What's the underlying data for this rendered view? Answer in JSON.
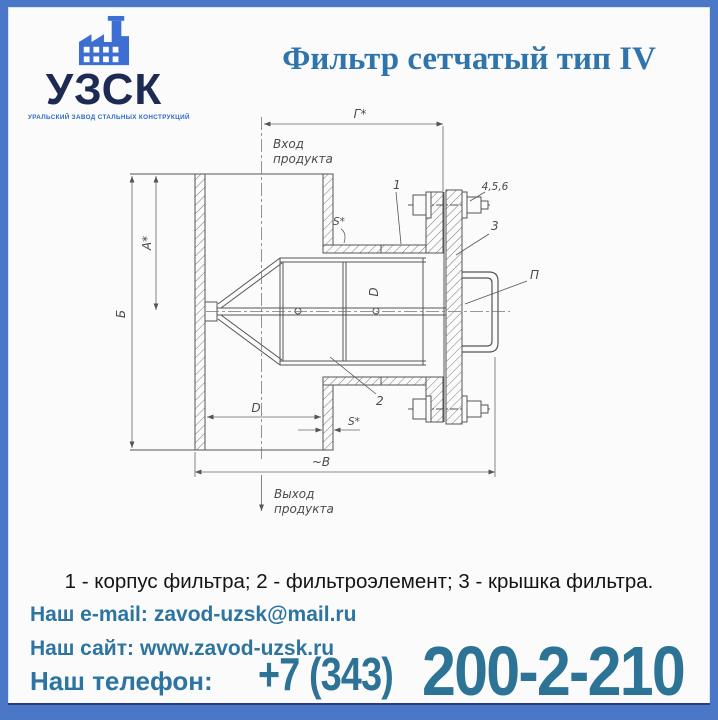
{
  "page": {
    "background": "#fbfbfb",
    "frame_color": "#4a77c8",
    "accent_color": "#2d74a1",
    "phone_digits_color": "#2d7396",
    "logo_navy": "#1d2a52",
    "logo_blue": "#3d6ed2"
  },
  "header": {
    "logo": {
      "icon": "factory-icon",
      "abbr": "УЗСК",
      "tagline": "УРАЛЬСКИЙ ЗАВОД СТАЛЬНЫХ КОНСТРУКЦИЙ"
    },
    "title": "Фильтр сетчатый тип IV"
  },
  "drawing": {
    "labels": {
      "inlet_l1": "Вход",
      "inlet_l2": "продукта",
      "outlet_l1": "Выход",
      "outlet_l2": "продукта",
      "dim_g": "Г*",
      "dim_a": "А*",
      "dim_b": "Б",
      "dim_w": "~В",
      "dim_d": "D",
      "dim_d_side": "D",
      "dim_s_top": "S*",
      "dim_s_bottom": "S*",
      "callout_body": "1",
      "callout_element": "2",
      "callout_cover": "3",
      "callout_fasteners": "4,5,6",
      "callout_handle": "П"
    }
  },
  "caption": "1 - корпус фильтра; 2 - фильтроэлемент; 3 - крышка фильтра.",
  "contacts": {
    "email_label": "Наш e-mail:",
    "email_value": "zavod-uzsk@mail.ru",
    "site_label": "Наш сайт:",
    "site_value": "www.zavod-uzsk.ru",
    "phone_label": "Наш телефон:",
    "phone_prefix": "+7 (343)",
    "phone_number": "200-2-210"
  }
}
